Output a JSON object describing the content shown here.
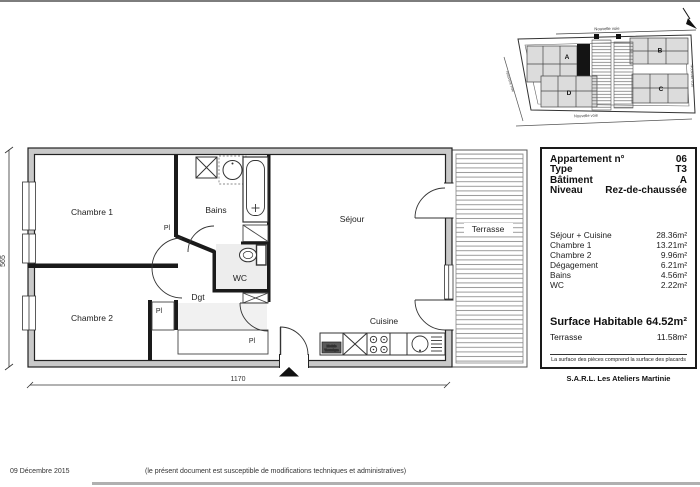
{
  "page": {
    "date": "09 Décembre 2015",
    "disclaimer": "(le présent document est susceptible de modifications techniques et administratives)",
    "company": "S.A.R.L. Les Ateliers Martinie"
  },
  "info_panel": {
    "header_rows": [
      {
        "label": "Appartement n°",
        "value": "06"
      },
      {
        "label": "Type",
        "value": "T3"
      },
      {
        "label": "Bâtiment",
        "value": "A"
      },
      {
        "label": "Niveau",
        "value": "Rez-de-chaussée"
      }
    ],
    "area_rows": [
      {
        "label": "Séjour + Cuisine",
        "value": "28.36m²"
      },
      {
        "label": "Chambre 1",
        "value": "13.21m²"
      },
      {
        "label": "Chambre 2",
        "value": "9.96m²"
      },
      {
        "label": "Dégagement",
        "value": "6.21m²"
      },
      {
        "label": "Bains",
        "value": "4.56m²"
      },
      {
        "label": "WC",
        "value": "2.22m²"
      }
    ],
    "total_row": {
      "label": "Surface Habitable",
      "value": "64.52m²"
    },
    "terrace_row": {
      "label": "Terrasse",
      "value": "11.58m²"
    },
    "footnote": "La surface des pièces comprend la surface des placards"
  },
  "floor_plan": {
    "rooms": {
      "chambre1": "Chambre 1",
      "chambre2": "Chambre 2",
      "bains": "Bains",
      "wc": "WC",
      "dgt": "Dgt",
      "sejour": "Séjour",
      "cuisine": "Cuisine",
      "terrasse": "Terrasse"
    },
    "closet": "Pl",
    "module_line1": "Module",
    "module_line2": "Thermique",
    "dim_width": "1170",
    "dim_height": "565"
  },
  "site_plan": {
    "streets": {
      "top": "Nouvelle voie",
      "right": "Nouvelle voie",
      "bottom": "Nouvelle voie",
      "left": "Nouvelle voie"
    },
    "buildings": {
      "a": "A",
      "b": "B",
      "c": "C",
      "d": "D"
    }
  }
}
